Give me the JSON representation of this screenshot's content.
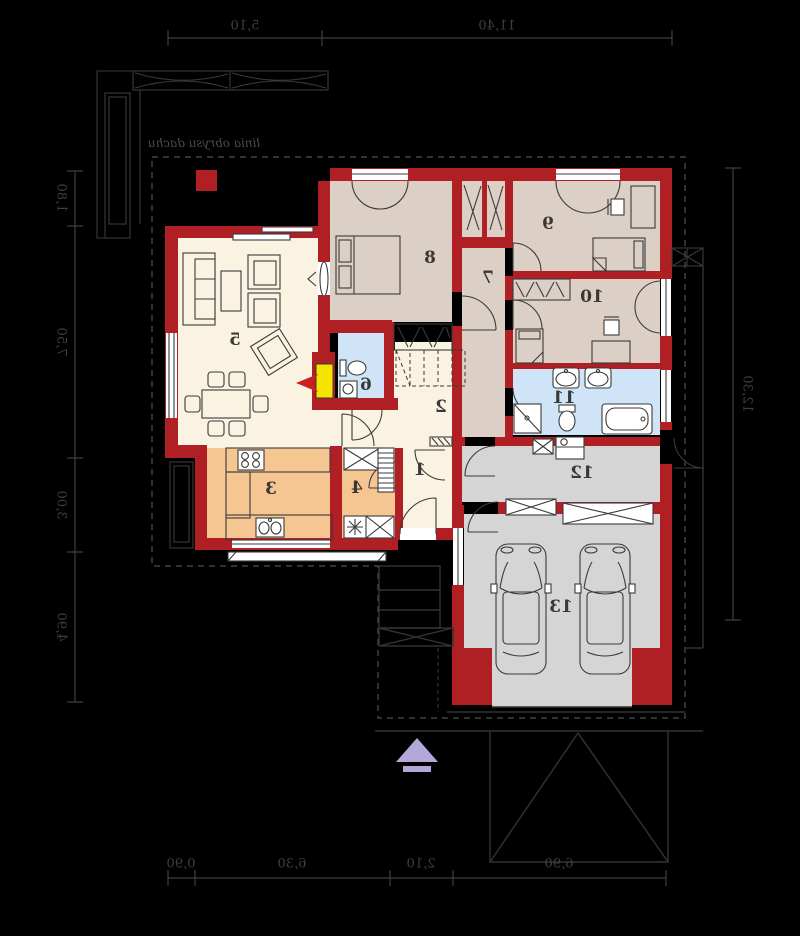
{
  "plan": {
    "roof_outline_label": "linia obrysu dachu",
    "rooms": {
      "1": "1",
      "2": "2",
      "3": "3",
      "4": "4",
      "5": "5",
      "6": "6",
      "7": "7",
      "8": "8",
      "9": "9",
      "10": "10",
      "11": "11",
      "12": "12",
      "13": "13"
    },
    "dimensions": {
      "top": [
        "5,10",
        "11,40"
      ],
      "left": [
        "1,80",
        "7,50",
        "3,00",
        "4,90"
      ],
      "right": [
        "12,30"
      ],
      "bottom": [
        "0,90",
        "6,30",
        "2,10",
        "6,90"
      ]
    }
  },
  "colors": {
    "background": "#000000",
    "wall": "#b01f24",
    "floor_cream": "#fbf3e2",
    "floor_beige": "#dcd0c6",
    "floor_blue": "#cfe5f7",
    "floor_orange": "#f6c692",
    "floor_gray": "#d5d5d5",
    "line_dark": "#3a3a3a",
    "dim": "#3f3f3f",
    "north_arrow": "#b3a8d8",
    "fireplace": "#f7e300",
    "accent_red": "#c9201d"
  }
}
